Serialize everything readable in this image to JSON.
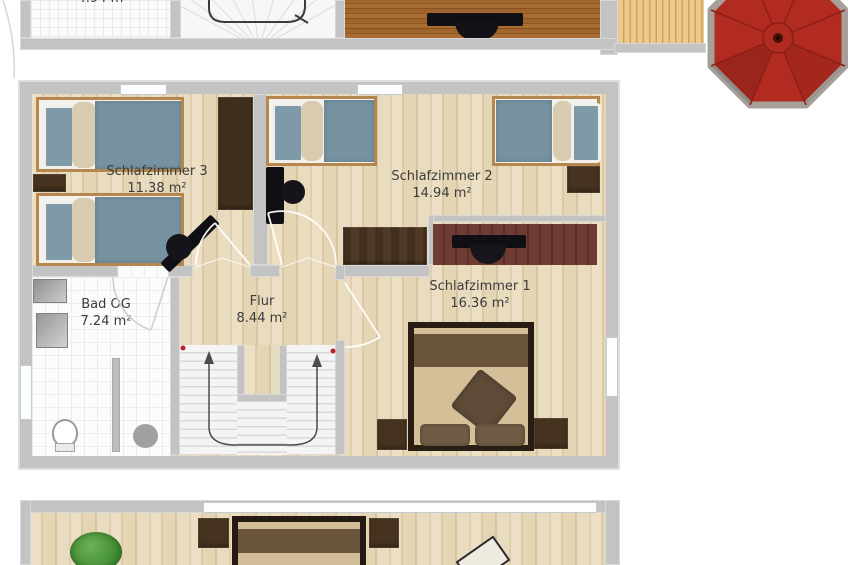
{
  "rooms": [
    {
      "name": "Schlafzimmer 3",
      "area": "11.38 m²"
    },
    {
      "name": "Schlafzimmer 2",
      "area": "14.94 m²"
    },
    {
      "name": "Schlafzimmer 1",
      "area": "16.36 m²"
    },
    {
      "name": "Bad OG",
      "area": "7.24 m²"
    },
    {
      "name": "Flur",
      "area": "8.44 m²"
    }
  ],
  "upper_floor_partial": {
    "area_label": "4.94 m²"
  },
  "colors": {
    "wall": "#c3c3c4",
    "wood_floor": "#e6d7ba",
    "dark_wood_floor": "#a2662e",
    "terrace_deck": "#e7c687",
    "umbrella_red": "#b12b21",
    "duvet_blue": "#7793a1",
    "furniture_dark_brown": "#46331f",
    "desk_mahogany": "#6a3c35",
    "bath_tile": "#fbfbfb",
    "stair_marker_red": "#c22222",
    "label_text": "#3c3c3c"
  },
  "icons": {
    "umbrella": "red-parasol-top-view",
    "plant": "green-plant-top-view",
    "stair_arrows": "stair-direction-arrows"
  }
}
